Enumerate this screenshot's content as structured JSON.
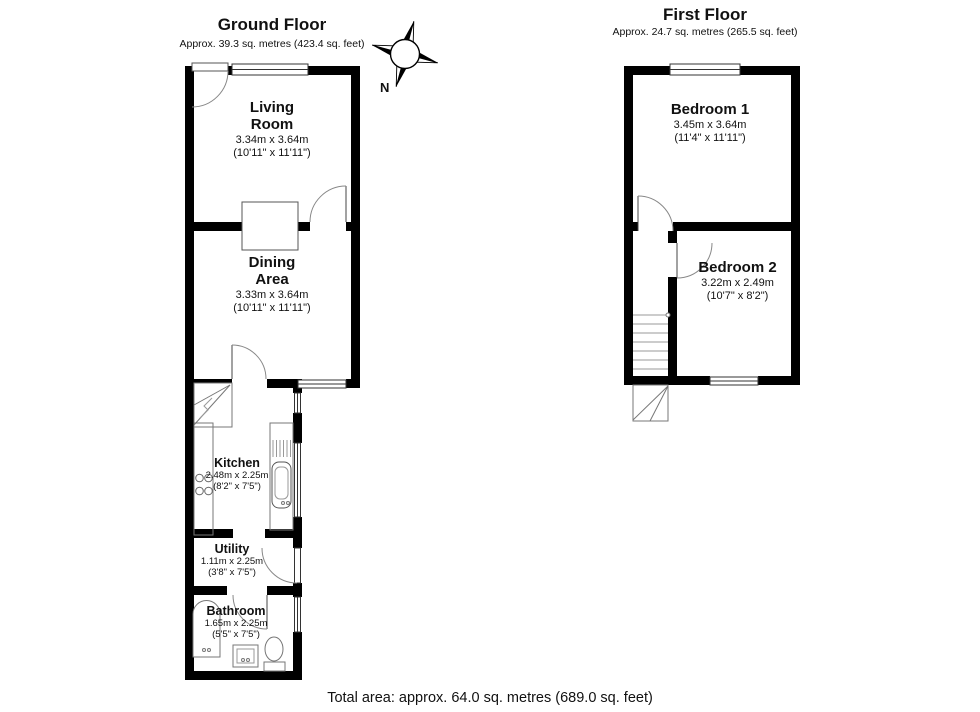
{
  "ground_floor": {
    "title": "Ground Floor",
    "subtitle": "Approx. 39.3 sq. metres (423.4 sq. feet)",
    "rooms": {
      "living_room": {
        "name": "Living\nRoom",
        "metric": "3.34m x 3.64m",
        "imperial": "(10'11\" x 11'11\")"
      },
      "dining_area": {
        "name": "Dining\nArea",
        "metric": "3.33m x 3.64m",
        "imperial": "(10'11\" x 11'11\")"
      },
      "kitchen": {
        "name": "Kitchen",
        "metric": "2.48m x 2.25m",
        "imperial": "(8'2\" x 7'5\")"
      },
      "utility": {
        "name": "Utility",
        "metric": "1.11m x 2.25m",
        "imperial": "(3'8\" x 7'5\")"
      },
      "bathroom": {
        "name": "Bathroom",
        "metric": "1.65m x 2.25m",
        "imperial": "(5'5\" x 7'5\")"
      }
    }
  },
  "first_floor": {
    "title": "First Floor",
    "subtitle": "Approx. 24.7 sq. metres (265.5 sq. feet)",
    "rooms": {
      "bedroom_1": {
        "name": "Bedroom 1",
        "metric": "3.45m x 3.64m",
        "imperial": "(11'4\" x 11'11\")"
      },
      "bedroom_2": {
        "name": "Bedroom 2",
        "metric": "3.22m x 2.49m",
        "imperial": "(10'7\" x 8'2\")"
      }
    }
  },
  "compass": {
    "label": "N"
  },
  "footer": {
    "total_area": "Total area: approx. 64.0 sq. metres (689.0 sq. feet)"
  },
  "colors": {
    "wall": "#000000",
    "fixture_line": "#777777",
    "background": "#ffffff"
  }
}
